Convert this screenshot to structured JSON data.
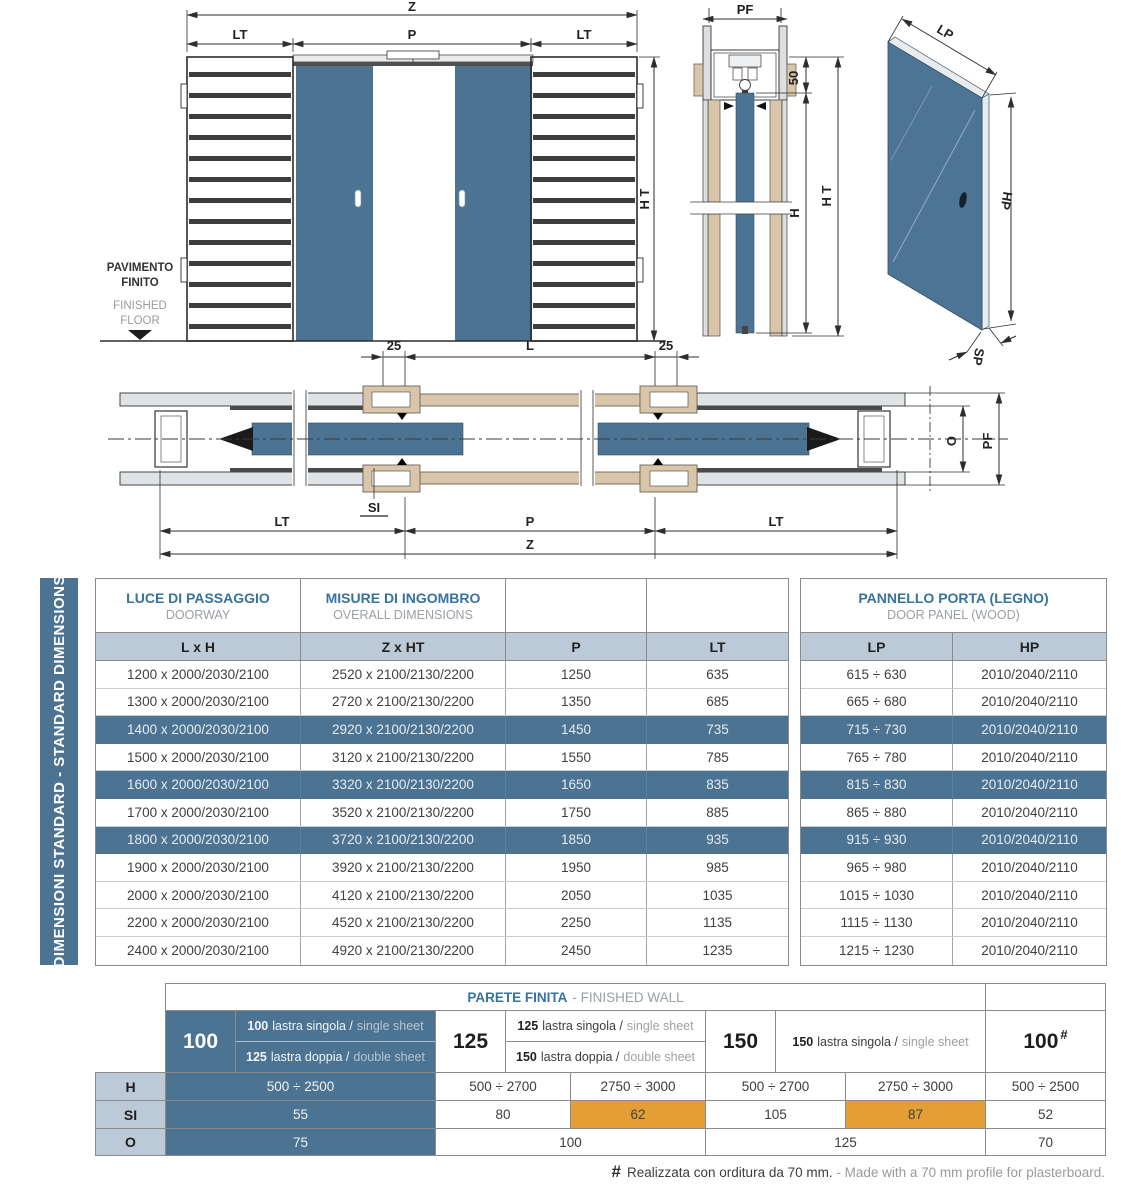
{
  "colors": {
    "steel_blue": "#4d7392",
    "light_blue": "#bccad8",
    "beige": "#d9c6aa",
    "orange": "#e39e35",
    "blue_text": "#36739e",
    "gray_text": "#9aa0a5"
  },
  "drawings": {
    "front_view": {
      "dim_z": "Z",
      "dim_lt_left": "LT",
      "dim_p": "P",
      "dim_lt_right": "LT",
      "dim_ht": "H T",
      "floor_it_line1": "PAVIMENTO",
      "floor_it_line2": "FINITO",
      "floor_en_line1": "FINISHED",
      "floor_en_line2": "FLOOR"
    },
    "section_view": {
      "dim_pf": "PF",
      "dim_50": "50",
      "dim_h": "H",
      "dim_ht": "H T"
    },
    "panel_view": {
      "dim_lp": "LP",
      "dim_hp": "HP",
      "dim_sp": "SP"
    },
    "plan_view": {
      "dim_25_left": "25",
      "dim_l": "L",
      "dim_25_right": "25",
      "dim_si": "SI",
      "dim_o": "O",
      "dim_pf": "PF",
      "dim_lt_left": "LT",
      "dim_p": "P",
      "dim_lt_right": "LT",
      "dim_z": "Z"
    }
  },
  "sidebar": {
    "label": "DIMENSIONI STANDARD - STANDARD DIMENSIONS"
  },
  "main_table": {
    "header": {
      "doorway_it": "LUCE DI PASSAGGIO",
      "doorway_en": "DOORWAY",
      "overall_it": "MISURE DI INGOMBRO",
      "overall_en": "OVERALL DIMENSIONS",
      "panel_it": "PANNELLO PORTA (LEGNO)",
      "panel_en": "DOOR PANEL (WOOD)"
    },
    "columns": {
      "lxh": "L x H",
      "zxht": "Z x HT",
      "p": "P",
      "lt": "LT",
      "lp": "LP",
      "hp": "HP"
    },
    "rows": [
      {
        "lxh": "1200 x 2000/2030/2100",
        "zxht": "2520 x 2100/2130/2200",
        "p": "1250",
        "lt": "635",
        "lp": "615 ÷ 630",
        "hp": "2010/2040/2110",
        "highlight": false
      },
      {
        "lxh": "1300 x 2000/2030/2100",
        "zxht": "2720 x 2100/2130/2200",
        "p": "1350",
        "lt": "685",
        "lp": "665 ÷ 680",
        "hp": "2010/2040/2110",
        "highlight": false
      },
      {
        "lxh": "1400 x 2000/2030/2100",
        "zxht": "2920 x 2100/2130/2200",
        "p": "1450",
        "lt": "735",
        "lp": "715 ÷ 730",
        "hp": "2010/2040/2110",
        "highlight": true
      },
      {
        "lxh": "1500 x 2000/2030/2100",
        "zxht": "3120 x 2100/2130/2200",
        "p": "1550",
        "lt": "785",
        "lp": "765 ÷ 780",
        "hp": "2010/2040/2110",
        "highlight": false
      },
      {
        "lxh": "1600 x 2000/2030/2100",
        "zxht": "3320 x 2100/2130/2200",
        "p": "1650",
        "lt": "835",
        "lp": "815 ÷ 830",
        "hp": "2010/2040/2110",
        "highlight": true
      },
      {
        "lxh": "1700 x 2000/2030/2100",
        "zxht": "3520 x 2100/2130/2200",
        "p": "1750",
        "lt": "885",
        "lp": "865 ÷ 880",
        "hp": "2010/2040/2110",
        "highlight": false
      },
      {
        "lxh": "1800 x 2000/2030/2100",
        "zxht": "3720 x 2100/2130/2200",
        "p": "1850",
        "lt": "935",
        "lp": "915 ÷ 930",
        "hp": "2010/2040/2110",
        "highlight": true
      },
      {
        "lxh": "1900 x 2000/2030/2100",
        "zxht": "3920 x 2100/2130/2200",
        "p": "1950",
        "lt": "985",
        "lp": "965 ÷ 980",
        "hp": "2010/2040/2110",
        "highlight": false
      },
      {
        "lxh": "2000 x 2000/2030/2100",
        "zxht": "4120 x 2100/2130/2200",
        "p": "2050",
        "lt": "1035",
        "lp": "1015 ÷ 1030",
        "hp": "2010/2040/2110",
        "highlight": false
      },
      {
        "lxh": "2200 x 2000/2030/2100",
        "zxht": "4520 x 2100/2130/2200",
        "p": "2250",
        "lt": "1135",
        "lp": "1115 ÷ 1130",
        "hp": "2010/2040/2110",
        "highlight": false
      },
      {
        "lxh": "2400 x 2000/2030/2100",
        "zxht": "4920 x 2100/2130/2200",
        "p": "2450",
        "lt": "1235",
        "lp": "1215 ÷ 1230",
        "hp": "2010/2040/2110",
        "highlight": false
      }
    ]
  },
  "wall_table": {
    "title_it": "PARETE FINITA",
    "title_en": "- FINISHED WALL",
    "row_labels": {
      "h": "H",
      "si": "SI",
      "o": "O"
    },
    "blocks": {
      "b100": {
        "label": "100",
        "line1_num": "100",
        "line1_it": "lastra singola /",
        "line1_en": "single sheet",
        "line2_num": "125",
        "line2_it": "lastra doppia /",
        "line2_en": "double sheet"
      },
      "b125": {
        "label": "125",
        "line1_num": "125",
        "line1_it": "lastra singola /",
        "line1_en": "single sheet",
        "line2_num": "150",
        "line2_it": "lastra doppia /",
        "line2_en": "double sheet"
      },
      "b150": {
        "label": "150",
        "line1_num": "150",
        "line1_it": "lastra singola /",
        "line1_en": "single sheet"
      },
      "b100p": {
        "label": "100",
        "sup": "#"
      }
    },
    "values": {
      "h_100": "500 ÷ 2500",
      "h_125_a": "500 ÷ 2700",
      "h_125_b": "2750 ÷ 3000",
      "h_150_a": "500 ÷ 2700",
      "h_150_b": "2750 ÷ 3000",
      "h_100p": "500 ÷ 2500",
      "si_100": "55",
      "si_125_a": "80",
      "si_125_b": "62",
      "si_150_a": "105",
      "si_150_b": "87",
      "si_100p": "52",
      "o_100": "75",
      "o_125": "100",
      "o_150": "125",
      "o_100p": "70"
    },
    "footnote": {
      "sym": "#",
      "it": "Realizzata con orditura da 70 mm.",
      "en": "- Made with a 70 mm profile for plasterboard."
    }
  }
}
